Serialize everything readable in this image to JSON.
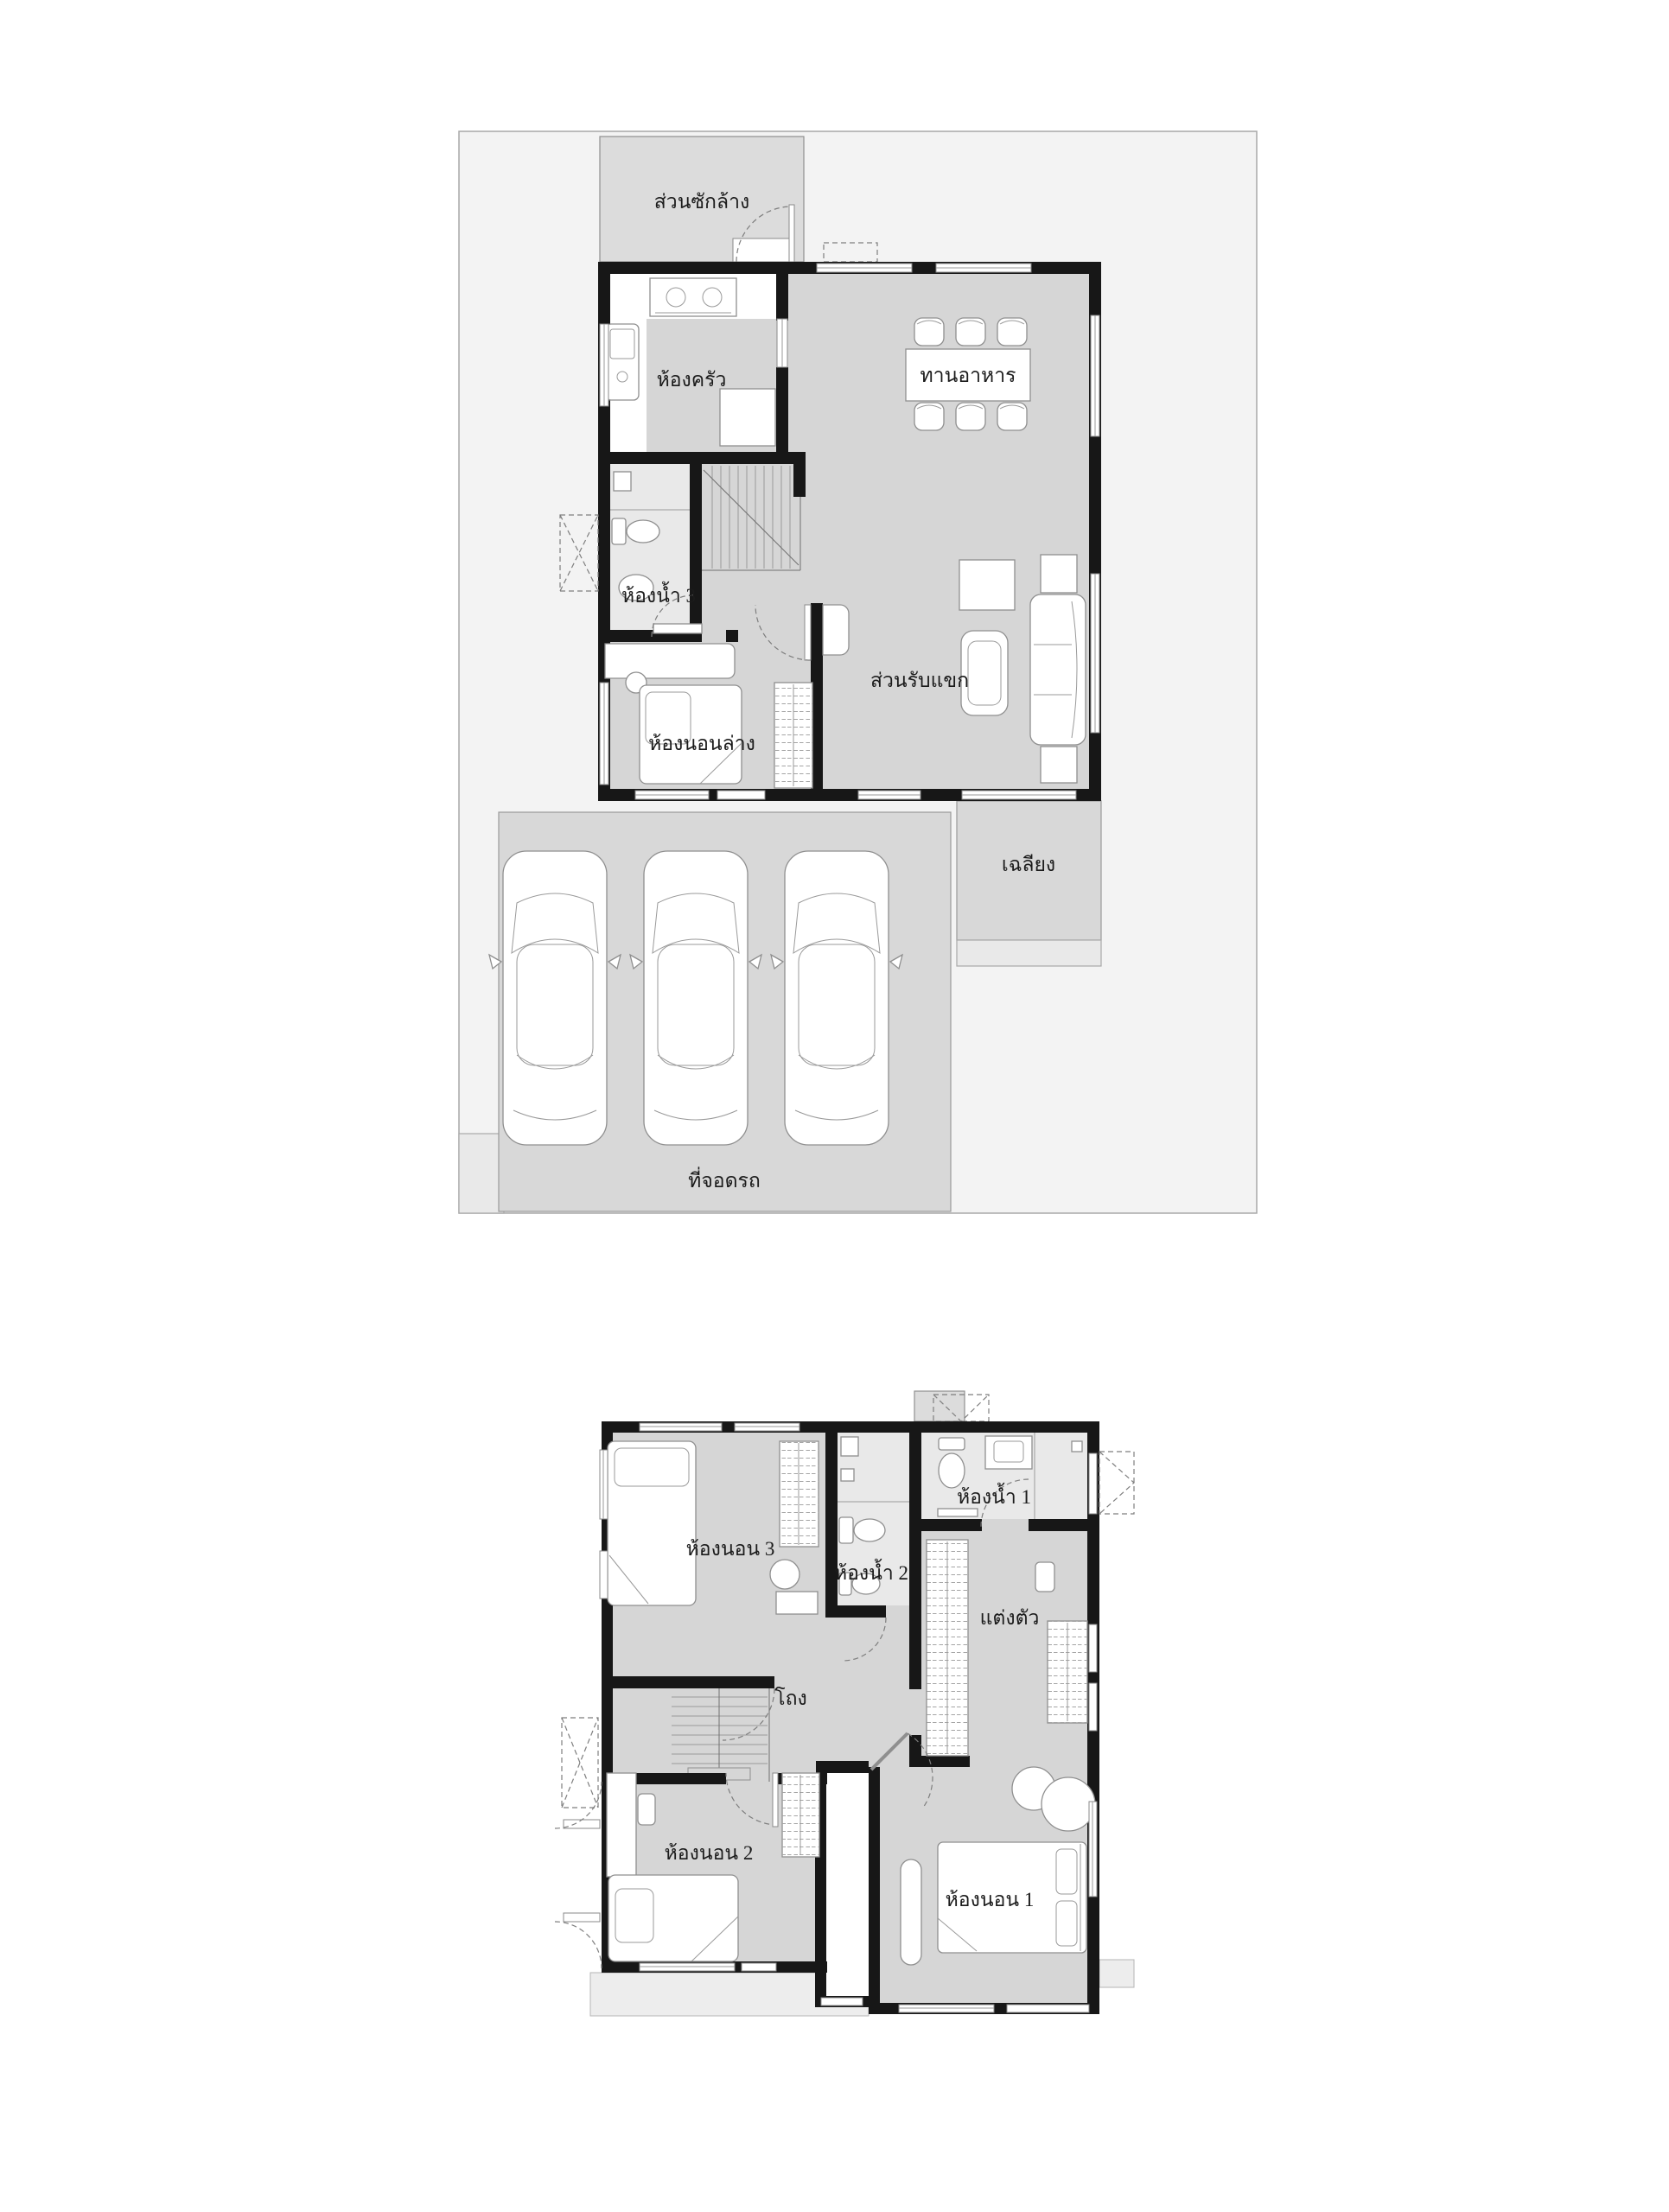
{
  "diagram": {
    "type": "house-floor-plan",
    "floors": 2
  },
  "palette": {
    "page_bg": "#ffffff",
    "site_bg": "#f3f3f3",
    "site_border": "#a8a8a8",
    "room_fill": "#d6d6d6",
    "bath_fill": "#e9e9e9",
    "service_fill": "#dcdcdc",
    "parking_fill": "#d8d8d8",
    "wall_color": "#171717",
    "label_color": "#1b1b1b"
  },
  "floor1": {
    "rooms": {
      "laundry": {
        "label": "ส่วนซักล้าง"
      },
      "kitchen": {
        "label": "ห้องครัว"
      },
      "dining": {
        "label": "ทานอาหาร"
      },
      "bath3": {
        "label": "ห้องน้ำ 3"
      },
      "bedroom_lower": {
        "label": "ห้องนอนล่าง"
      },
      "living": {
        "label": "ส่วนรับแขก"
      },
      "porch": {
        "label": "เฉลียง"
      },
      "parking": {
        "label": "ที่จอดรถ",
        "car_count": 3
      }
    }
  },
  "floor2": {
    "rooms": {
      "bedroom3": {
        "label": "ห้องนอน 3"
      },
      "bath2": {
        "label": "ห้องน้ำ 2"
      },
      "bath1": {
        "label": "ห้องน้ำ 1"
      },
      "dressing": {
        "label": "แต่งตัว"
      },
      "hall": {
        "label": "โถง"
      },
      "bedroom2": {
        "label": "ห้องนอน 2"
      },
      "bedroom1": {
        "label": "ห้องนอน 1"
      }
    }
  }
}
